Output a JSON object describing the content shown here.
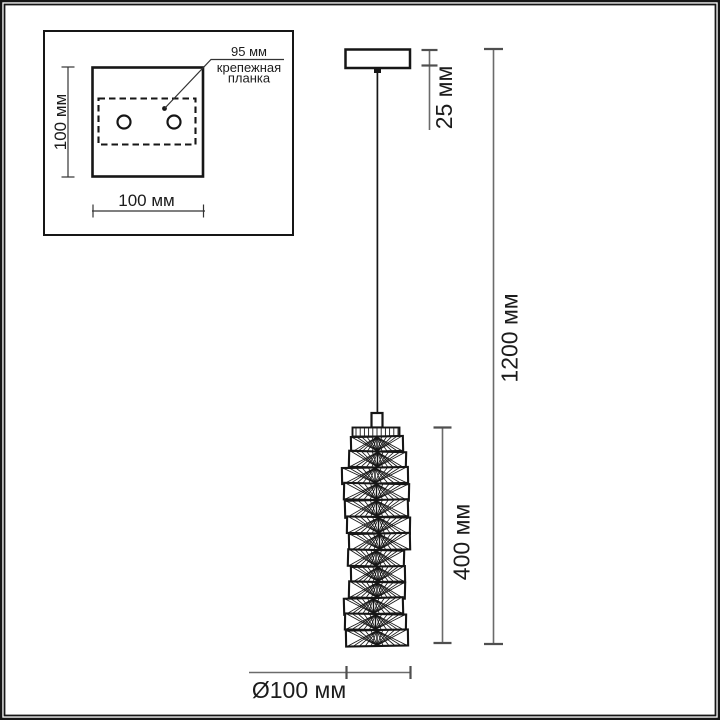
{
  "inset": {
    "height_label": "100 мм",
    "width_label": "100 мм",
    "bracket_offset_label": "95 мм",
    "bracket_name_line1": "крепежная",
    "bracket_name_line2": "планка"
  },
  "pendant": {
    "canopy_height_label": "25 мм",
    "total_height_label": "1200 мм",
    "shade_height_label": "400 мм",
    "shade_diameter_label": "Ø100 мм"
  },
  "colors": {
    "ink": "#161616",
    "dim_line": "#6b6b6b",
    "dim_tick": "#4f4f4f",
    "text": "#1c1c1c",
    "background": "#ffffff"
  }
}
